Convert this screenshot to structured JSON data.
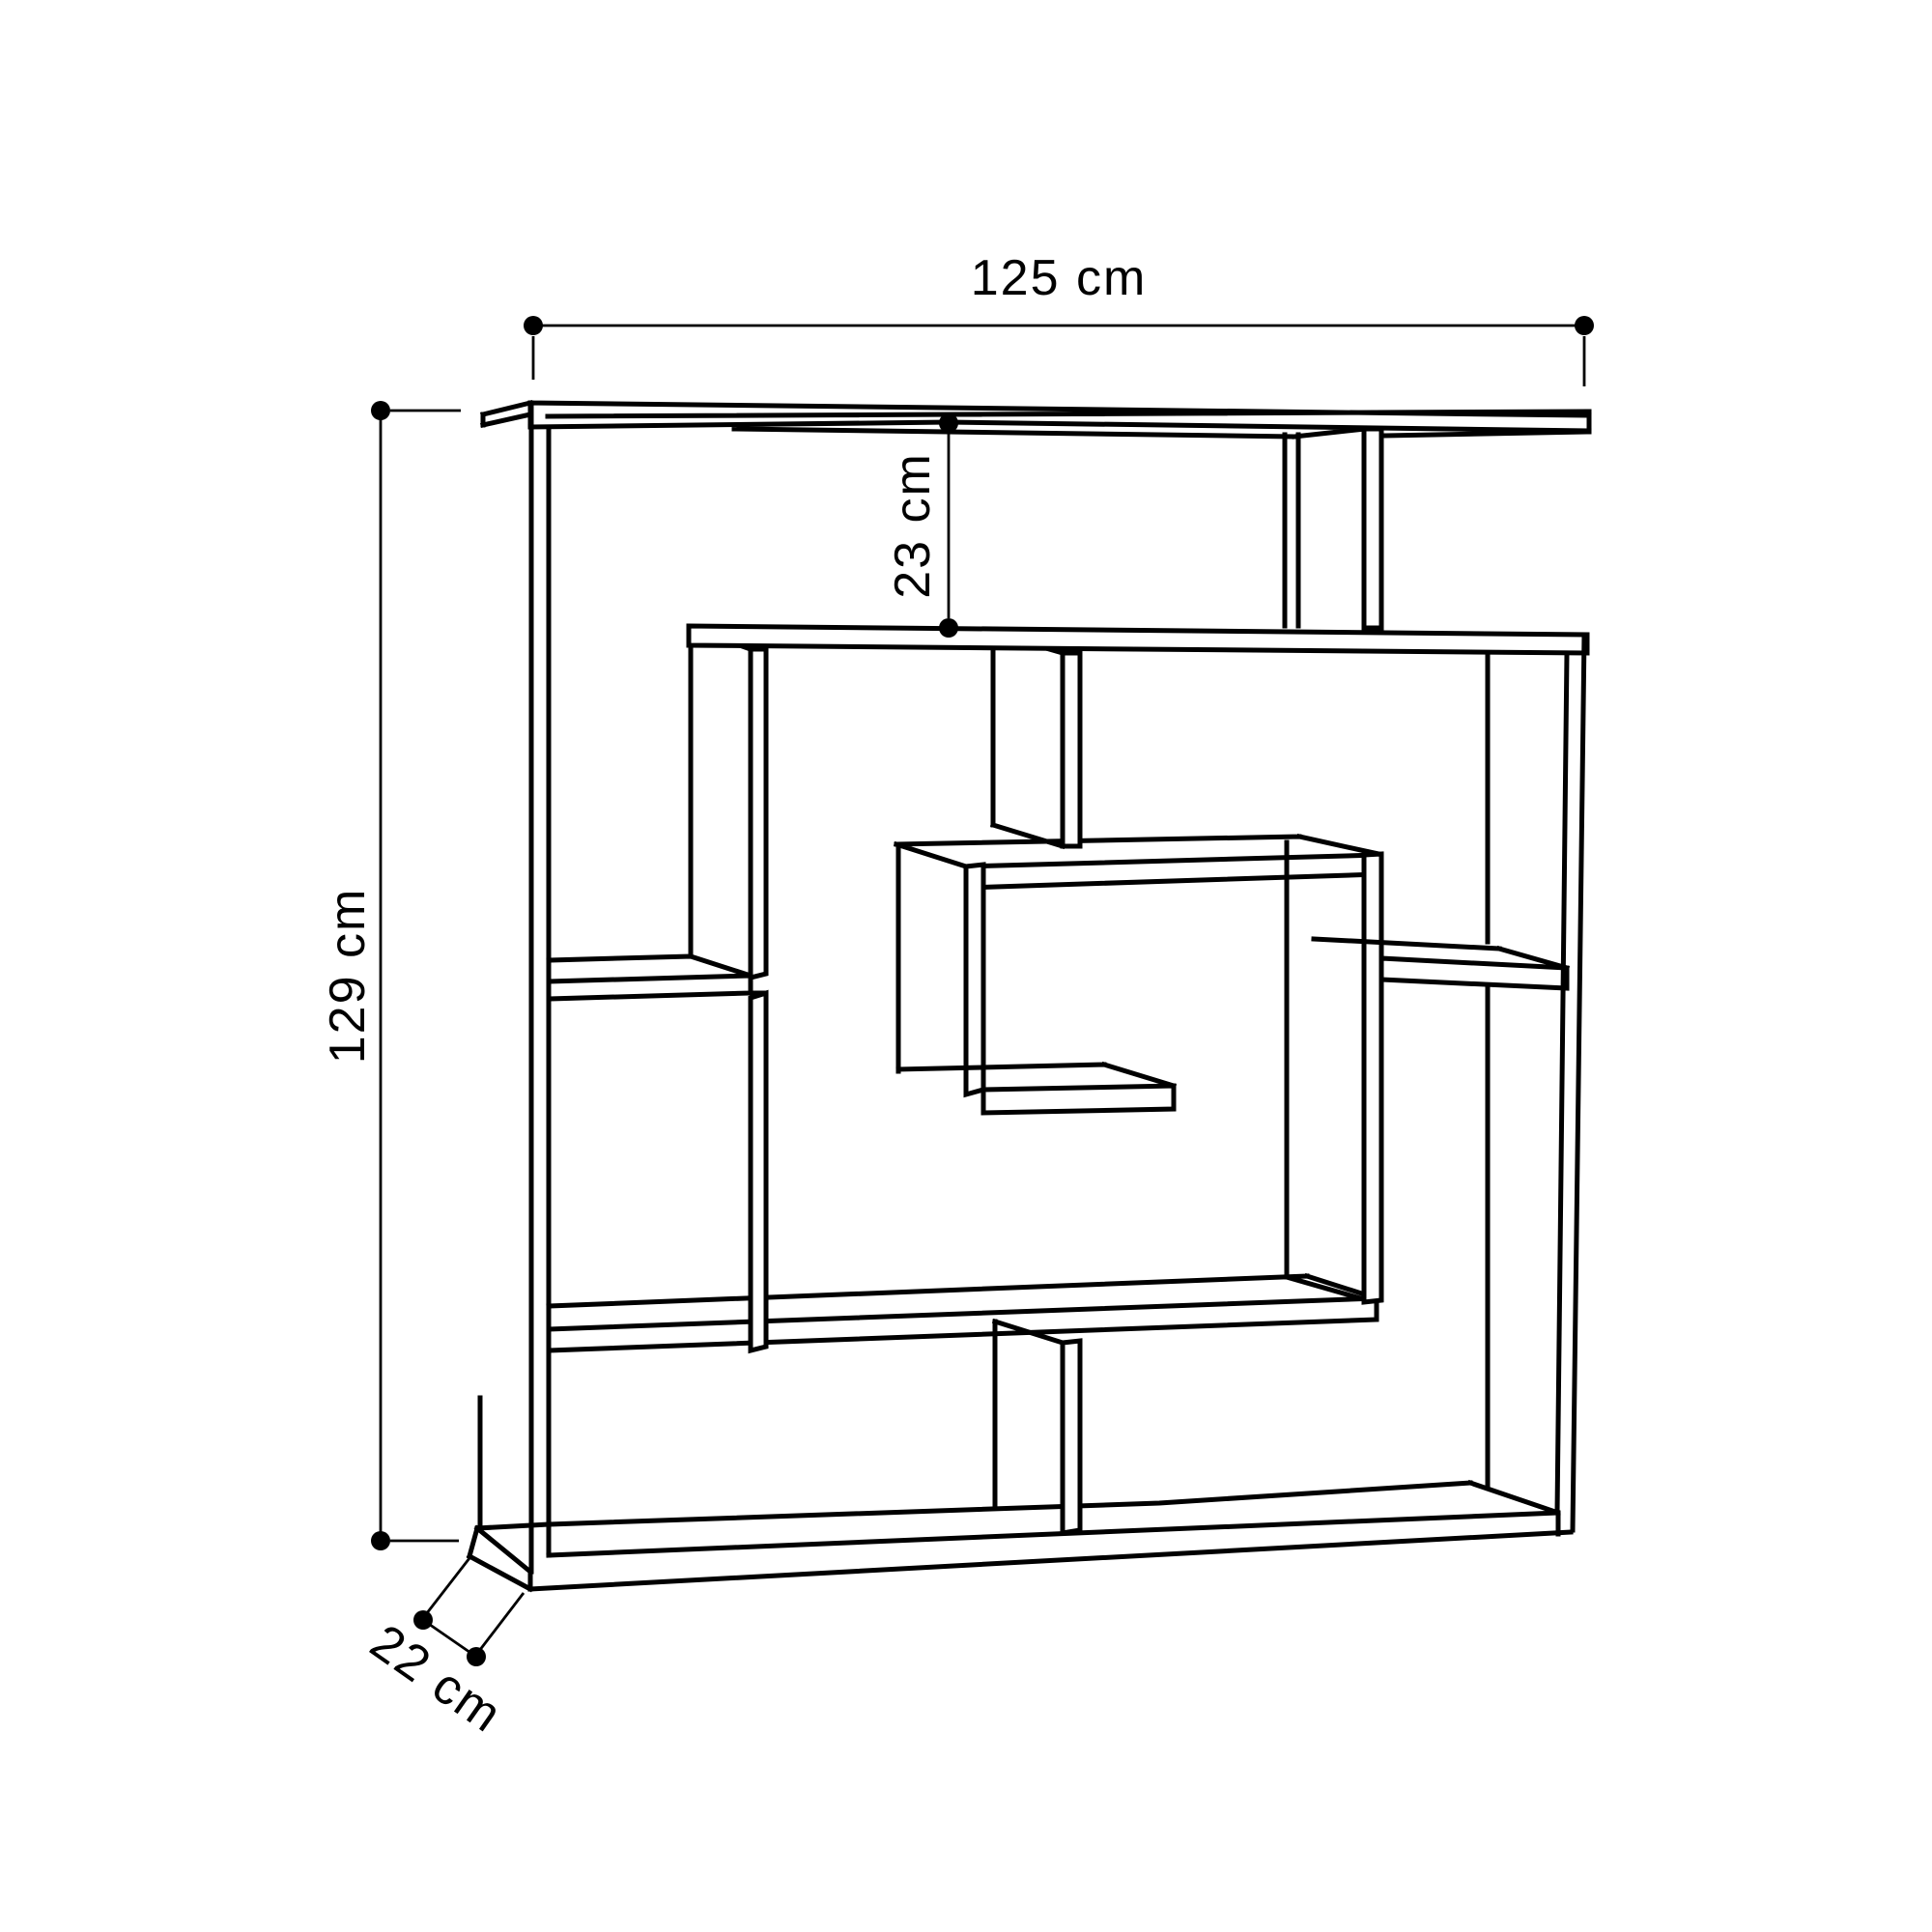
{
  "diagram": {
    "type": "furniture-dimension-drawing",
    "subject": "maze-style open bookcase",
    "style": {
      "background": "#ffffff",
      "line_color": "#000000",
      "dot_radius": 10
    },
    "dimensions": {
      "width": {
        "value": 125,
        "unit": "cm",
        "label": "125 cm"
      },
      "height": {
        "value": 129,
        "unit": "cm",
        "label": "129 cm"
      },
      "top_shelf_gap": {
        "value": 23,
        "unit": "cm",
        "label": "23 cm"
      },
      "depth": {
        "value": 22,
        "unit": "cm",
        "label": "22 cm"
      }
    }
  }
}
